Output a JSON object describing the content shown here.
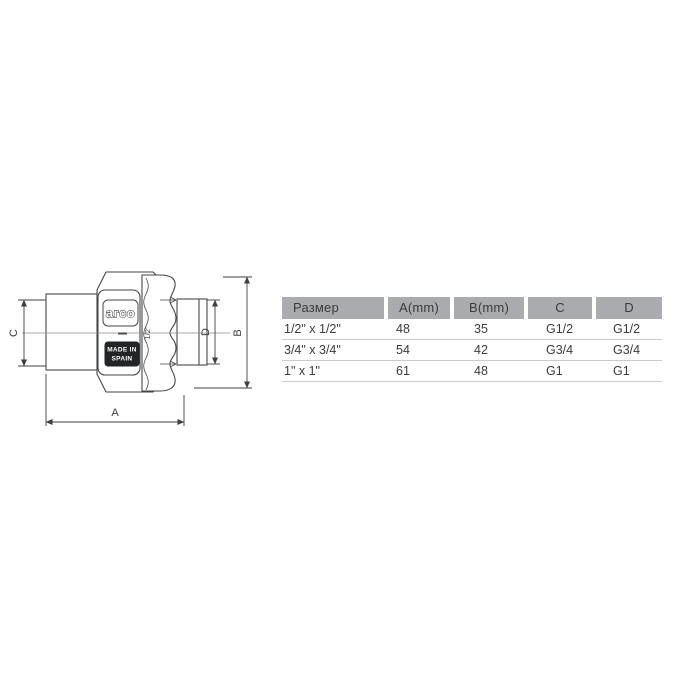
{
  "page": {
    "background": "#ffffff"
  },
  "drawing": {
    "brand_label": "arco",
    "origin_line1": "MADE IN",
    "origin_line2": "SPAIN",
    "size_marking": "1/2\"",
    "dimension_labels": {
      "a": "A",
      "b": "B",
      "c": "C",
      "d": "D"
    }
  },
  "table": {
    "columns": [
      "Размер",
      "A(mm)",
      "B(mm)",
      "C",
      "D"
    ],
    "rows": [
      [
        "1/2\" x 1/2\"",
        "48",
        "35",
        "G1/2",
        "G1/2"
      ],
      [
        "3/4\" x 3/4\"",
        "54",
        "42",
        "G3/4",
        "G3/4"
      ],
      [
        "1\" x 1\"",
        "61",
        "48",
        "G1",
        "G1"
      ]
    ],
    "header_bg": "#a9abae",
    "text_color": "#3b3b3d",
    "separator_color": "#c9cbcd",
    "line_color": "#3f3f41"
  }
}
